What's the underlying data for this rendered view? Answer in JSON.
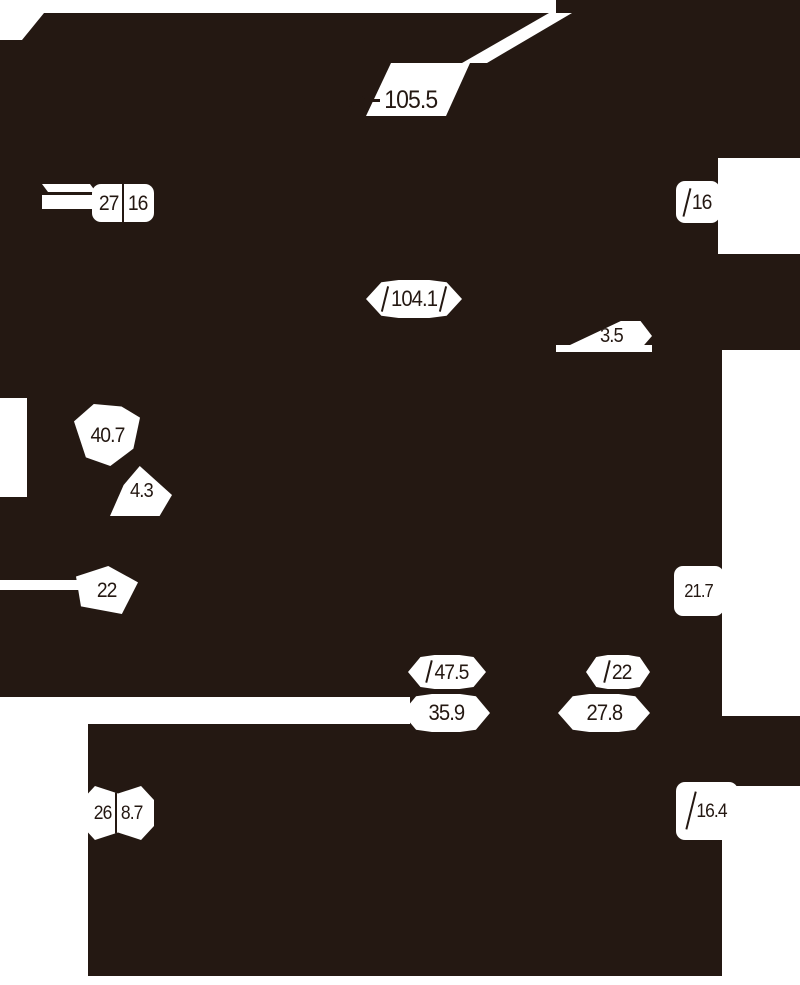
{
  "drawing": {
    "description": "Black product silhouette with white dimension callouts",
    "colors": {
      "silhouette": "#241812",
      "paper": "#ffffff"
    }
  },
  "dimensions": [
    {
      "id": "top-overall-length",
      "value": "105.5"
    },
    {
      "id": "upper-left-width",
      "value": "27"
    },
    {
      "id": "upper-left-height",
      "value": "16"
    },
    {
      "id": "upper-right",
      "value": "16"
    },
    {
      "id": "mid-overall-length",
      "value": "104.1"
    },
    {
      "id": "mid-offset",
      "value": "3.5"
    },
    {
      "id": "left-depth",
      "value": "40.7"
    },
    {
      "id": "left-small",
      "value": "4.3"
    },
    {
      "id": "left-width",
      "value": "22"
    },
    {
      "id": "right-mid-height",
      "value": "21.7"
    },
    {
      "id": "lower-front-length",
      "value": "47.5"
    },
    {
      "id": "lower-rear-width",
      "value": "22"
    },
    {
      "id": "lower-front-width",
      "value": "35.9"
    },
    {
      "id": "lower-rear-length",
      "value": "27.8"
    },
    {
      "id": "bottom-left-width",
      "value": "26"
    },
    {
      "id": "bottom-left-small",
      "value": "8.7"
    },
    {
      "id": "bottom-right-height",
      "value": "16.4"
    }
  ]
}
